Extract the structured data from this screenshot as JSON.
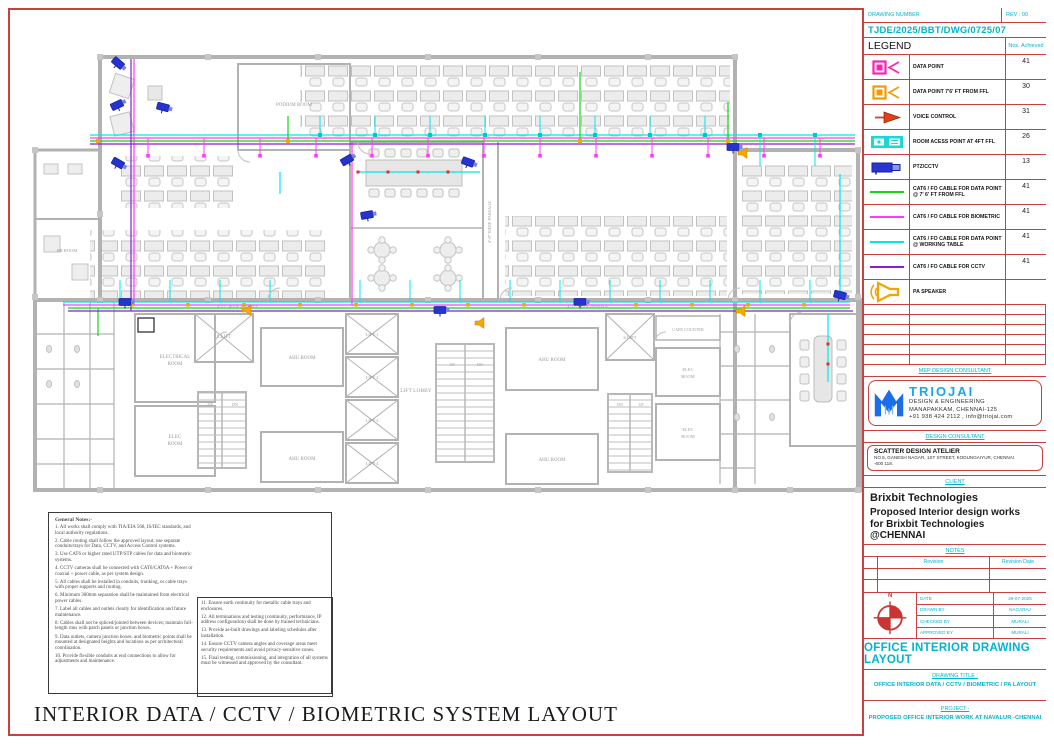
{
  "sheet_title": "INTERIOR DATA / CCTV / BIOMETRIC SYSTEM   LAYOUT",
  "title_block": {
    "drawing_number_label": "DRAWING NUMBER",
    "rev_label": "REV : 00",
    "drawing_number": "TJDE/2025/BBT/DWG/0725/07",
    "legend_label": "LEGEND",
    "nos_achieved_label": "Nos. Achieved",
    "mep_label": "MEP DESIGN CONSULTANT",
    "design_consultant_label": "DESIGN CONSULTANT",
    "client_label": "CLIENT",
    "notes_label": "NOTES",
    "revision_header": "Revision",
    "revision_date_header": "Revision Date",
    "north_label": "N",
    "triojai": {
      "name": "TRIOJAI",
      "line1": "DESIGN & ENGINEERING",
      "line2": "MANAPAKKAM, CHENNAI-125",
      "line3": "+91 938 424 2112 , info@triojai.com"
    },
    "scatter": {
      "name": "SCATTER DESIGN ATELIER",
      "address": "NO.5, GANESH NAGAR, 1ST STREET, KODUNGAIYUR, CHENNAI -600 118."
    },
    "client_name": "Brixbit Technologies",
    "client_desc": "Proposed Interior design works for Brixbit Technologies @CHENNAI",
    "info_rows": [
      {
        "label": "DATE",
        "value": "29-07-2025"
      },
      {
        "label": "DRAWN BY",
        "value": "NAGARAJ"
      },
      {
        "label": "CHECKED BY",
        "value": "MURALI"
      },
      {
        "label": "APPROVED BY",
        "value": "MURALI"
      }
    ],
    "office_layout_title": "OFFICE INTERIOR DRAWING LAYOUT",
    "drawing_title_label": "DRAWING TITLE :",
    "drawing_title": "OFFICE INTERIOR DATA / CCTV / BIOMETRIC / PA  LAYOUT",
    "project_label": "PROJECT:-",
    "project_title": "PROPOSED OFFICE  INTERIOR WORK AT NAVALUR -CHENNAI"
  },
  "legend_items": [
    {
      "icon": "data-point-icon",
      "color": "#ff1fb0",
      "label": "DATA POINT",
      "count": "41"
    },
    {
      "icon": "data-point-ffl-icon",
      "color": "#f59a00",
      "label": "DATA POINT 7'6' FT FROM FFL",
      "count": "30"
    },
    {
      "icon": "voice-control-icon",
      "color": "#e0401a",
      "label": "VOICE CONTROL",
      "count": "31"
    },
    {
      "icon": "room-access-point-icon",
      "color": "#1fd6d6",
      "label": "ROOM ACESS POINT AT 4FT FFL",
      "count": "26"
    },
    {
      "icon": "ptz-cctv-icon",
      "color": "#2a35cf",
      "label": "PTZ/CCTV",
      "count": "13"
    },
    {
      "icon": "cable-line",
      "color": "#17d417",
      "label": "CAT6 / FO CABLE FOR DATA POINT @ 7' 6' FT FROM FFL",
      "count": "41"
    },
    {
      "icon": "cable-line",
      "color": "#ff3df0",
      "label": "CAT6 / FO CABLE FOR BIOMETRIC",
      "count": "41"
    },
    {
      "icon": "cable-line",
      "color": "#00e8e8",
      "label": "CAT6 / FO CABLE FOR DATA POINT @ WORKING TABLE",
      "count": "41"
    },
    {
      "icon": "cable-line",
      "color": "#8a1fd4",
      "label": "CAT6 / FO CABLE FOR CCTV",
      "count": "41"
    },
    {
      "icon": "pa-speaker-icon",
      "color": "#f0a500",
      "label": "PA SPEAKER",
      "count": ""
    }
  ],
  "general_notes": {
    "title": "General Notes:-",
    "left": [
      "1. All works shall comply with TIA/EIA 568, IS/IEC standards, and local authority regulations.",
      "2. Cable routing shall follow the approved layout; use separate conduits/trays for Data, CCTV, and Access Control systems.",
      "3. Use CAT6 or higher rated UTP/STP cables for data and biometric systems.",
      "4. CCTV cameras shall be connected with CAT6/CAT6A + Power or coaxial + power cable, as per system design.",
      "5. All cables shall be installed in conduits, trunking, or cable trays with proper supports and routing.",
      "6. Minimum 300mm separation shall be maintained from electrical power cables.",
      "7. Label all cables and outlets clearly for identification and future maintenance.",
      "8. Cables shall not be spliced/jointed between devices; maintain full-length runs with patch panels or junction boxes.",
      "9. Data outlets, camera junction boxes, and biometric points shall be mounted at designated heights and locations as per architectural coordination.",
      "10. Provide flexible conduits at end connections to allow for adjustments and maintenance."
    ],
    "right": [
      "11.   Ensure earth continuity for metallic cable trays and enclosures.",
      "12. All terminations and testing (continuity, performance, IP address configuration) shall be done by trained technicians.",
      "13. Provide as-built drawings and labeling schedules after installation.",
      "14. Ensure CCTV camera angles and coverage areas meet security requirements and avoid privacy-sensitive zones.",
      "15. Final testing, commissioning, and integration of all systems must be witnessed and approved by the consultant."
    ]
  },
  "floor_plan": {
    "labels": [
      {
        "text": "PODIUM ROOM",
        "x": 266,
        "y": 92,
        "s": 5
      },
      {
        "text": "HR ROOM",
        "x": 39,
        "y": 238,
        "s": 4.5
      },
      {
        "text": "S.LIFT",
        "x": 196,
        "y": 324,
        "s": 5
      },
      {
        "text": "ELECTRICAL",
        "x": 147,
        "y": 344,
        "s": 5
      },
      {
        "text": "ROOM",
        "x": 147,
        "y": 351,
        "s": 5
      },
      {
        "text": "ELEC",
        "x": 147,
        "y": 424,
        "s": 5
      },
      {
        "text": "ROOM",
        "x": 147,
        "y": 431,
        "s": 5
      },
      {
        "text": "AHU ROOM",
        "x": 274,
        "y": 345,
        "s": 5
      },
      {
        "text": "AHU ROOM",
        "x": 274,
        "y": 446,
        "s": 5
      },
      {
        "text": "LIFT-1",
        "x": 344,
        "y": 322,
        "s": 4.5
      },
      {
        "text": "LIFT-2",
        "x": 344,
        "y": 365,
        "s": 4.5
      },
      {
        "text": "LIFT-3",
        "x": 344,
        "y": 408,
        "s": 4.5
      },
      {
        "text": "LIFT-4",
        "x": 344,
        "y": 451,
        "s": 4.5
      },
      {
        "text": "LIFT LOBBY",
        "x": 388,
        "y": 378,
        "s": 5.5
      },
      {
        "text": "UP",
        "x": 424,
        "y": 352,
        "s": 4
      },
      {
        "text": "DN",
        "x": 452,
        "y": 352,
        "s": 4
      },
      {
        "text": "AHU ROOM",
        "x": 524,
        "y": 347,
        "s": 5
      },
      {
        "text": "AHU ROOM",
        "x": 524,
        "y": 447,
        "s": 5
      },
      {
        "text": "S.LIFT",
        "x": 602,
        "y": 325,
        "s": 4.5
      },
      {
        "text": "CAFE COUNTER",
        "x": 660,
        "y": 317,
        "s": 4.2
      },
      {
        "text": "ELEC",
        "x": 660,
        "y": 357,
        "s": 4.5
      },
      {
        "text": "ROOM",
        "x": 660,
        "y": 364,
        "s": 4.5
      },
      {
        "text": "ELEC",
        "x": 660,
        "y": 417,
        "s": 4.5
      },
      {
        "text": "ROOM",
        "x": 660,
        "y": 424,
        "s": 4.5
      },
      {
        "text": "UP",
        "x": 182,
        "y": 392,
        "s": 4
      },
      {
        "text": "DN",
        "x": 207,
        "y": 392,
        "s": 4
      },
      {
        "text": "DN",
        "x": 592,
        "y": 392,
        "s": 4
      },
      {
        "text": "UP",
        "x": 613,
        "y": 392,
        "s": 4
      },
      {
        "text": "4'-0\" WIDE PASSAGE",
        "x": 463,
        "y": 208,
        "s": 4.5,
        "r": -90
      },
      {
        "text": "4'-11\" WIDE PASSAGE",
        "x": 210,
        "y": 294,
        "s": 4.2
      },
      {
        "text": "4'-11\" WIDE PASSAGE",
        "x": 560,
        "y": 294,
        "s": 4.2
      }
    ]
  }
}
